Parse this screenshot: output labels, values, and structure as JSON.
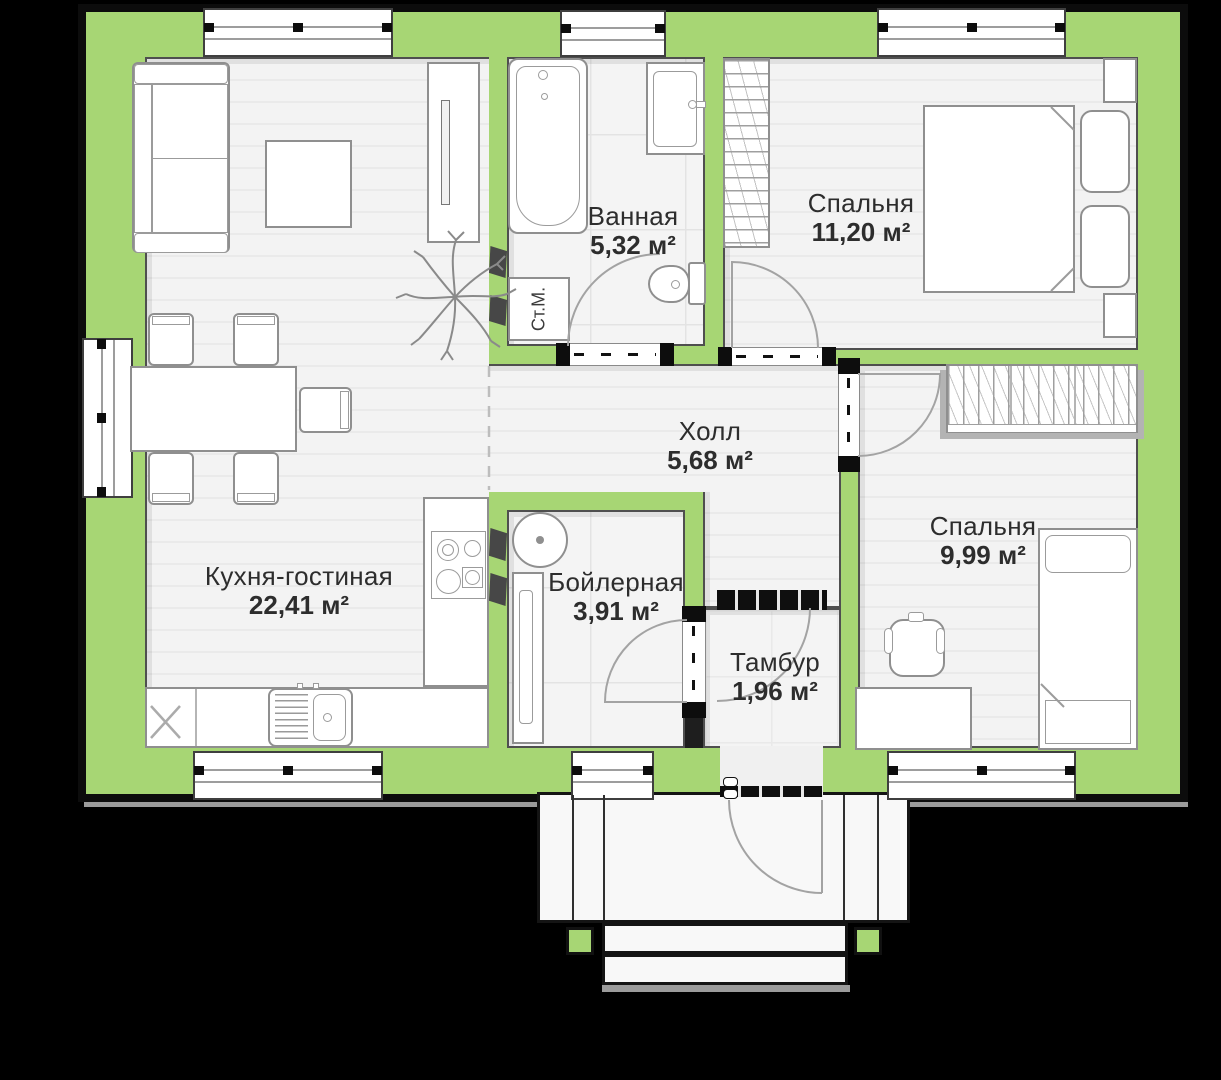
{
  "plan": {
    "rooms": [
      {
        "id": "bathroom",
        "name": "Ванная",
        "area": "5,32 м²"
      },
      {
        "id": "bedroom-1",
        "name": "Спальня",
        "area": "11,20 м²"
      },
      {
        "id": "hall",
        "name": "Холл",
        "area": "5,68 м²"
      },
      {
        "id": "kitchen-living",
        "name": "Кухня-гостиная",
        "area": "22,41 м²"
      },
      {
        "id": "boiler-room",
        "name": "Бойлерная",
        "area": "3,91 м²"
      },
      {
        "id": "vestibule",
        "name": "Тамбур",
        "area": "1,96 м²"
      },
      {
        "id": "bedroom-2",
        "name": "Спальня",
        "area": "9,99 м²"
      }
    ],
    "appliance_labels": {
      "washing_machine": "Ст.М."
    },
    "colors": {
      "wall_green": "#a7d674",
      "outline_black": "#0c0c0c",
      "floor_gray": "#f2f2f2",
      "background": "#000000"
    }
  }
}
